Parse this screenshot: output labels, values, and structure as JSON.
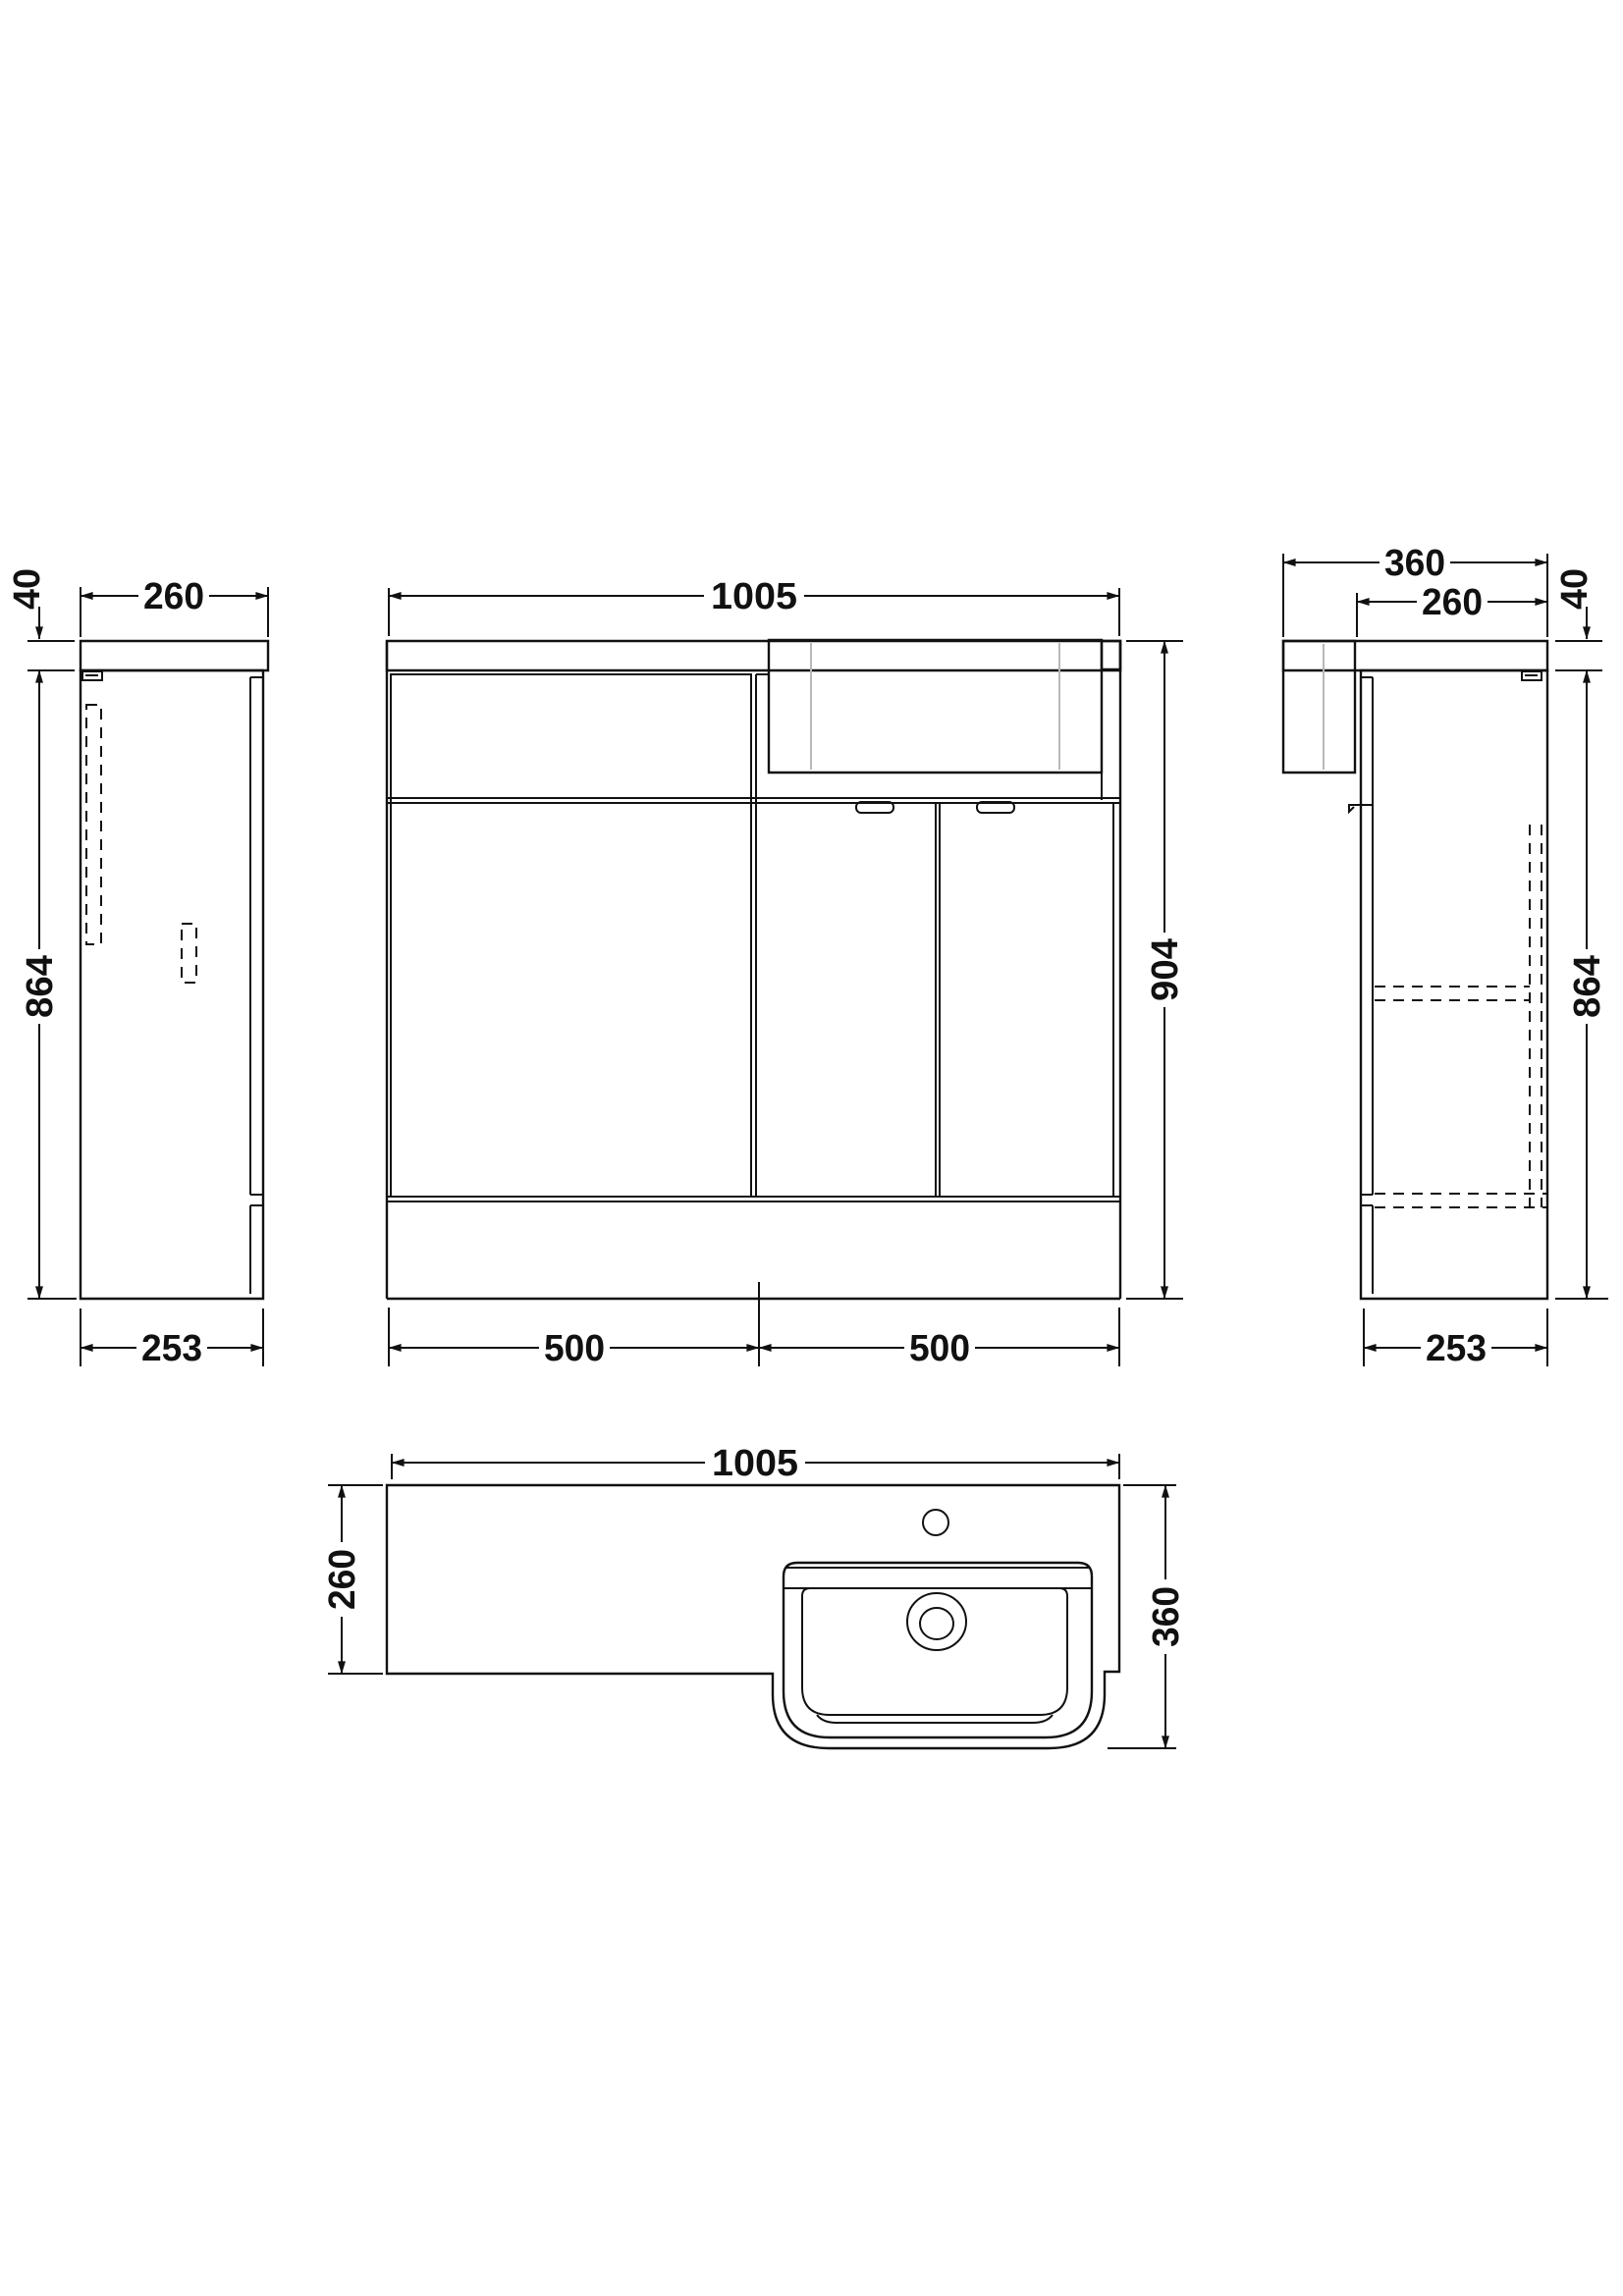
{
  "drawing": {
    "type": "orthographic-technical-drawing",
    "subject": "L-shaped bathroom vanity and WC combination unit with semi-recessed basin",
    "units": "mm",
    "colors": {
      "line": "#111111",
      "accent_gray": "#b8b8b8",
      "background": "#ffffff"
    },
    "views": {
      "left_side": {
        "name": "left side elevation",
        "dims": {
          "top_thickness": "40",
          "top_depth": "260",
          "height": "864",
          "base_depth": "253"
        }
      },
      "front": {
        "name": "front elevation",
        "dims": {
          "overall_width": "1005",
          "overall_height": "904",
          "left_width": "500",
          "right_width": "500"
        }
      },
      "right_side": {
        "name": "right side elevation",
        "dims": {
          "overall_depth": "360",
          "counter_depth": "260",
          "top_thickness": "40",
          "height": "864",
          "base_depth": "253"
        }
      },
      "plan": {
        "name": "plan view",
        "dims": {
          "overall_width": "1005",
          "counter_depth": "260",
          "overall_depth": "360"
        }
      }
    }
  }
}
